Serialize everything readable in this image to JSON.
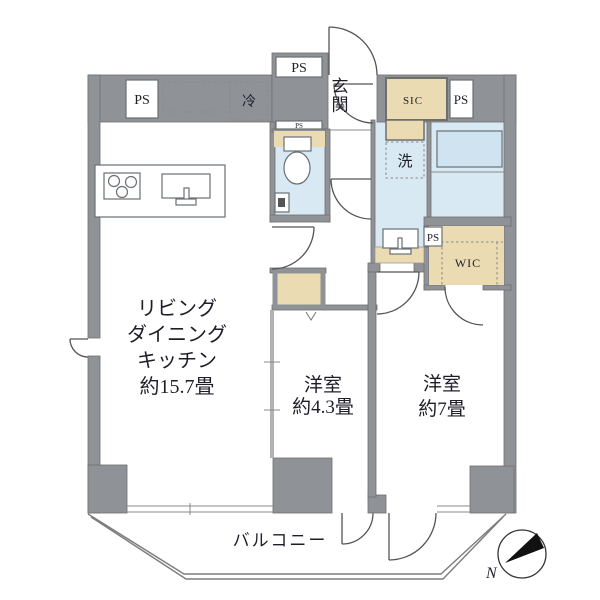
{
  "labels": {
    "ps": "PS",
    "sic": "SIC",
    "wic": "WIC",
    "refrigerator": "冷",
    "washer": "洗",
    "entrance": "玄関",
    "balcony": "バルコニー",
    "compass_north": "N"
  },
  "rooms": {
    "ldk": {
      "lines": [
        "リビング",
        "ダイニング",
        "キッチン",
        "約15.7畳"
      ]
    },
    "bedroom_small": {
      "lines": [
        "洋室",
        "約4.3畳"
      ]
    },
    "bedroom_large": {
      "lines": [
        "洋室",
        "約7畳"
      ]
    }
  },
  "colors": {
    "wall_gray": "#8f9296",
    "closet_beige": "#ebdbb2",
    "water_blue": "#d9e9f3",
    "outline": "#555555",
    "text": "#1e1e28"
  }
}
